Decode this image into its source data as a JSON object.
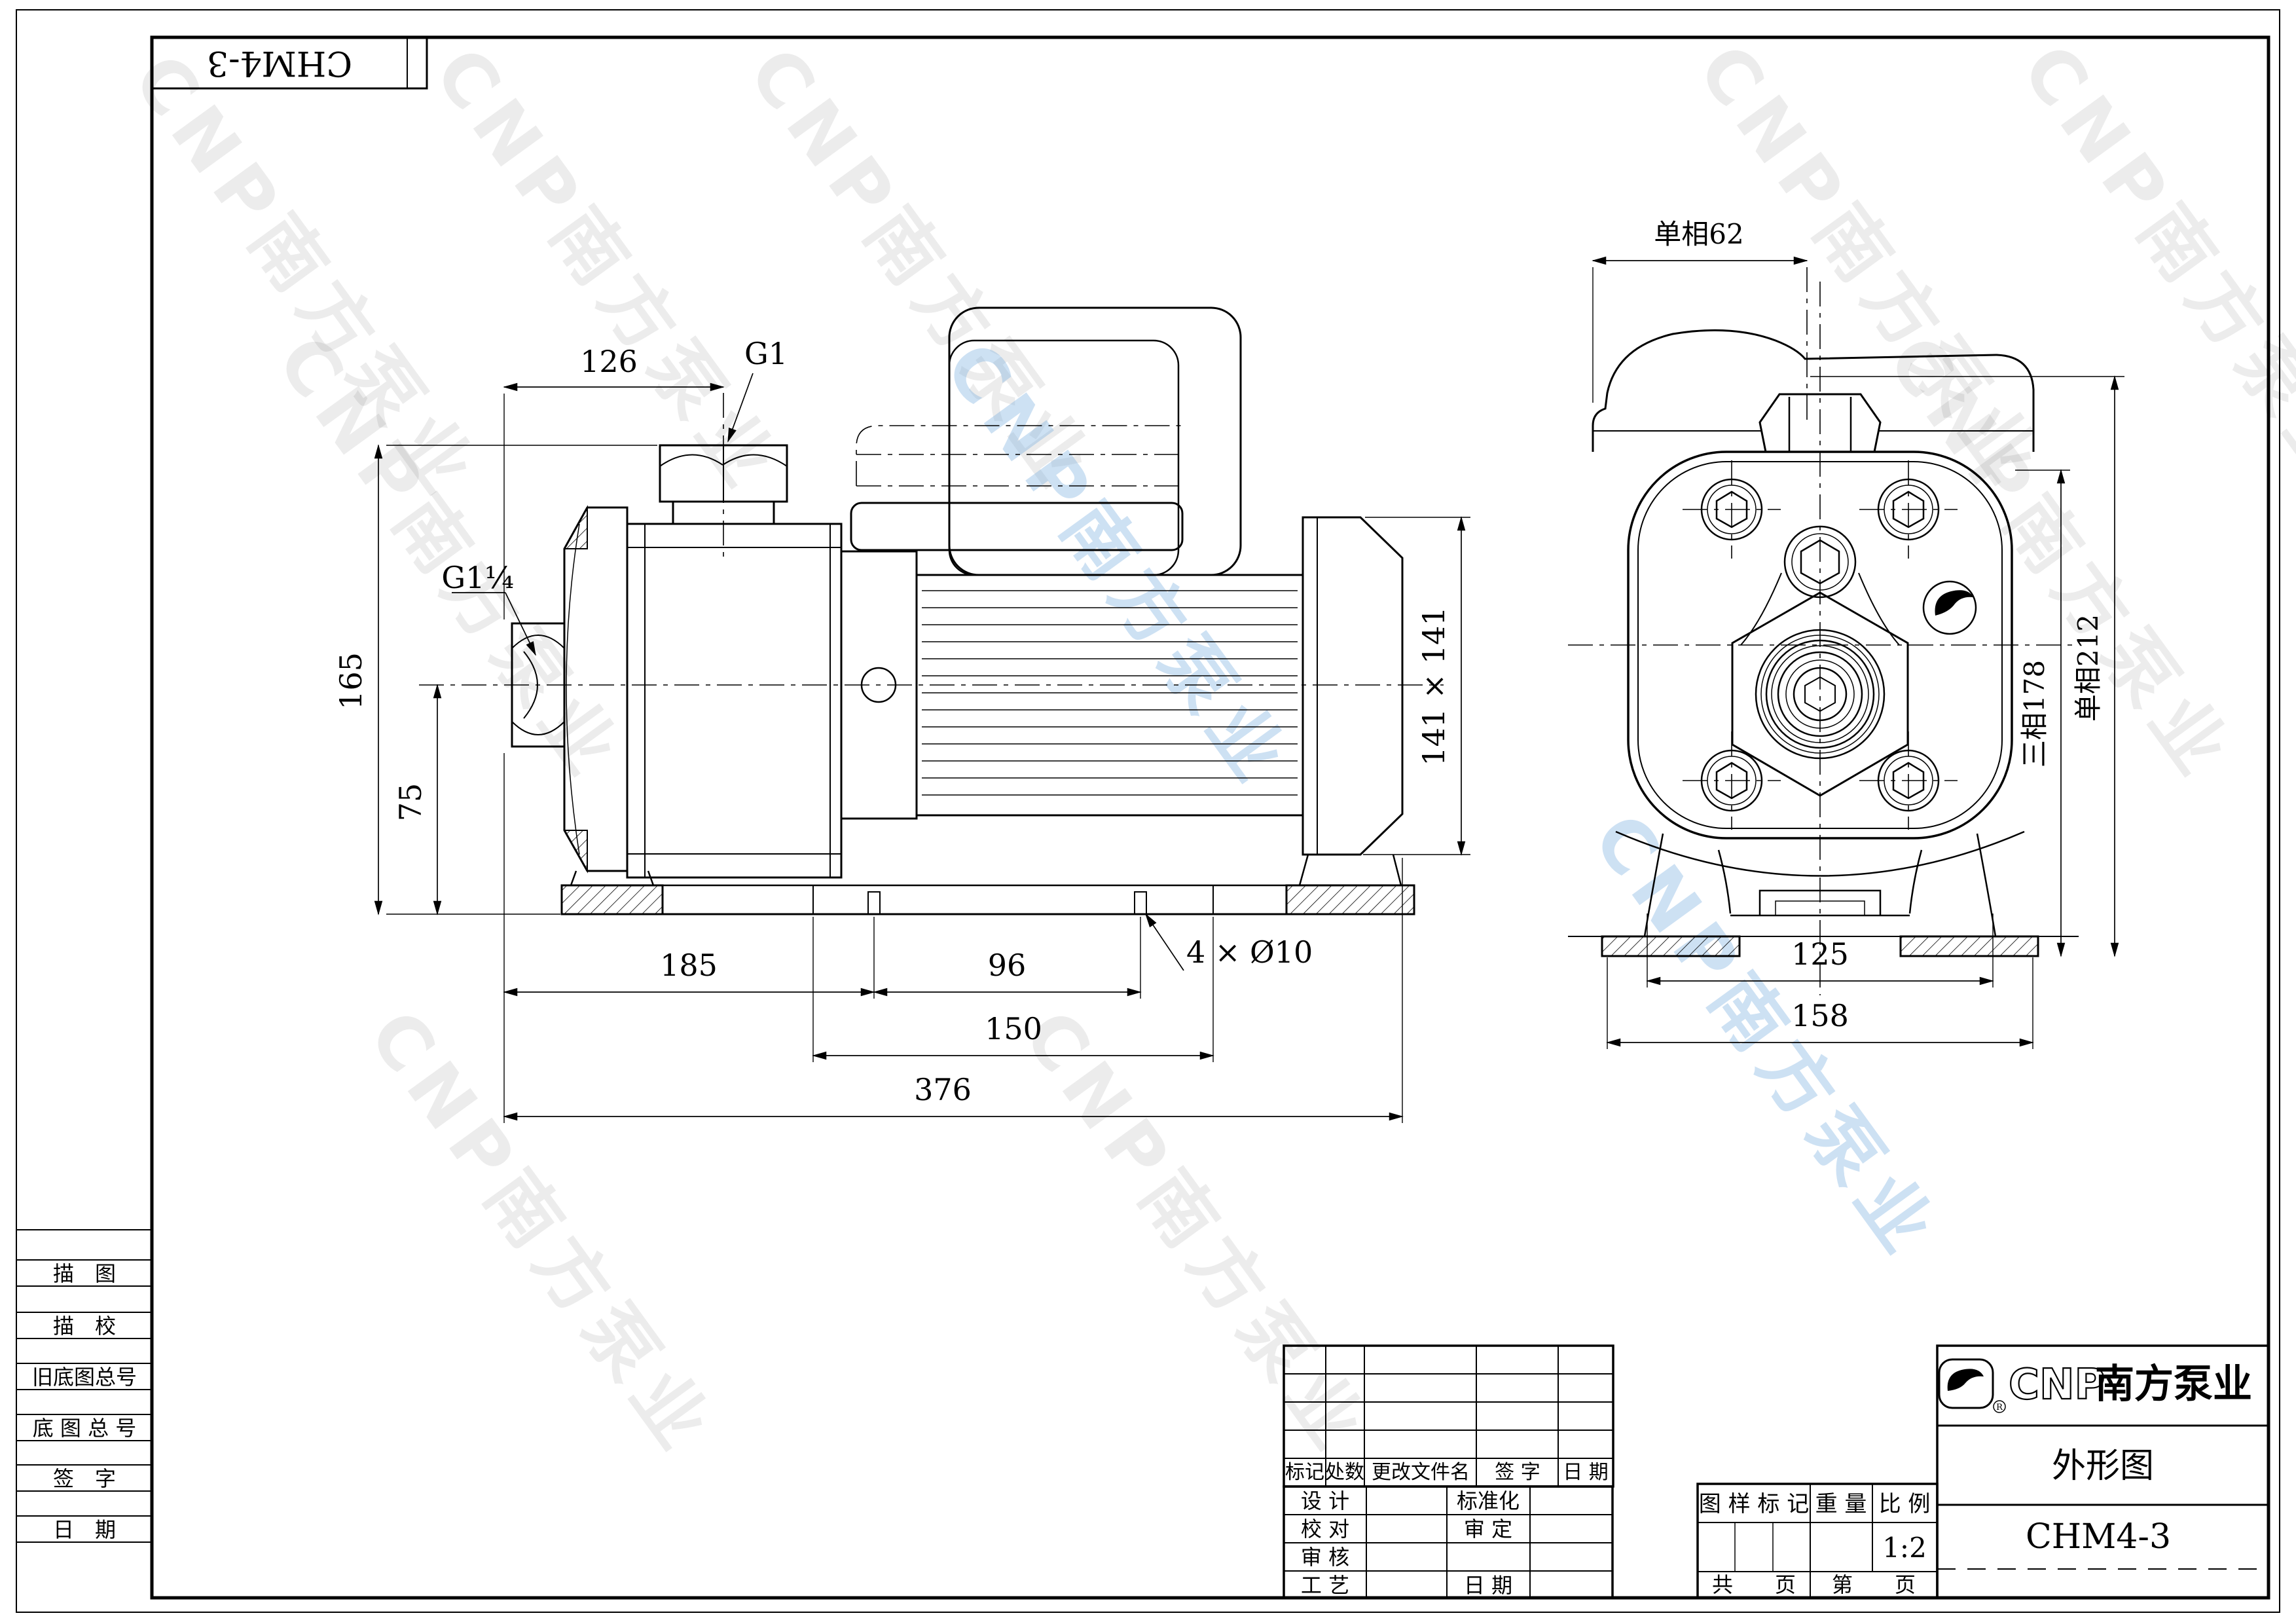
{
  "top_label": {
    "model": "CHM4-3"
  },
  "watermark": {
    "text": "CNP南方泵业"
  },
  "side_view": {
    "dim_126": "126",
    "dim_g1": "G1",
    "dim_g1q": "G1¼",
    "dim_165": "165",
    "dim_75": "75",
    "dim_185": "185",
    "dim_96": "96",
    "dim_150": "150",
    "dim_376": "376",
    "dim_holes": "4 × Ø10",
    "dim_141": "141 × 141"
  },
  "front_view": {
    "dim_62": "单相62",
    "dim_178": "三相178",
    "dim_212": "单相212",
    "dim_125": "125",
    "dim_158": "158"
  },
  "sidebar": {
    "rows": [
      "描　图",
      "描　校",
      "旧底图总号",
      "底 图 总 号",
      "签　字",
      "日　期"
    ]
  },
  "title_block": {
    "rev_headers": [
      "标记",
      "处数",
      "更改文件名",
      "签  字",
      "日  期"
    ],
    "design": "设  计",
    "standardize": "标准化",
    "proof": "校  对",
    "approve": "审  定",
    "review": "审  核",
    "process": "工  艺",
    "date": "日  期",
    "stamp": "图  样  标  记",
    "weight": "重  量",
    "scale_label": "比  例",
    "scale": "1:2",
    "total_pages": "共　　页",
    "page_no": "第　　页",
    "brand": "CNP",
    "brand_cn": "南方泵业",
    "reg": "R",
    "doc_title": "外形图",
    "model": "CHM4-3"
  }
}
